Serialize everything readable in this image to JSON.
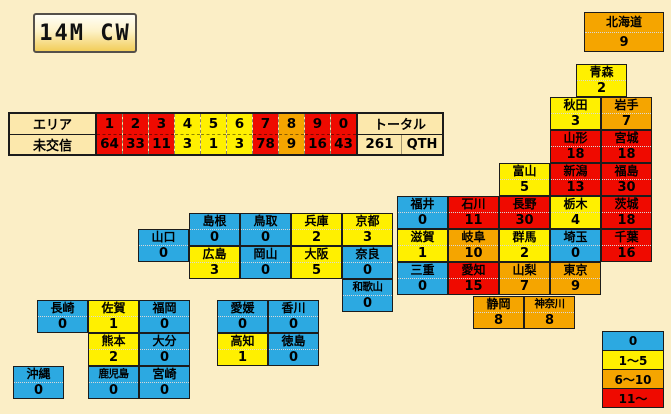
{
  "window": {
    "title": "14M CW"
  },
  "area_table": {
    "row1_label": "エリア",
    "row2_label": "未交信",
    "areas": [
      {
        "area": "1",
        "count": "64",
        "level": "red"
      },
      {
        "area": "2",
        "count": "33",
        "level": "red"
      },
      {
        "area": "3",
        "count": "11",
        "level": "red"
      },
      {
        "area": "4",
        "count": "3",
        "level": "yellow"
      },
      {
        "area": "5",
        "count": "1",
        "level": "yellow"
      },
      {
        "area": "6",
        "count": "3",
        "level": "yellow"
      },
      {
        "area": "7",
        "count": "78",
        "level": "red"
      },
      {
        "area": "8",
        "count": "9",
        "level": "orange"
      },
      {
        "area": "9",
        "count": "16",
        "level": "red"
      },
      {
        "area": "0",
        "count": "43",
        "level": "red"
      }
    ],
    "total_label": "トータル",
    "total_value": "261",
    "total_unit": "QTH"
  },
  "legend": {
    "items": [
      {
        "label": "0",
        "level": "blue"
      },
      {
        "label": "1～5",
        "level": "yellow"
      },
      {
        "label": "6～10",
        "level": "orange"
      },
      {
        "label": "11～",
        "level": "red"
      }
    ]
  },
  "map": {
    "prefectures": [
      {
        "name": "北海道",
        "count": "9",
        "level": "orange",
        "x": 584,
        "y": 12,
        "w": 80,
        "h": 40
      },
      {
        "name": "青森",
        "count": "2",
        "level": "yellow",
        "x": 576,
        "y": 64
      },
      {
        "name": "秋田",
        "count": "3",
        "level": "yellow",
        "x": 550,
        "y": 97
      },
      {
        "name": "岩手",
        "count": "7",
        "level": "orange",
        "x": 601,
        "y": 97
      },
      {
        "name": "山形",
        "count": "18",
        "level": "red",
        "x": 550,
        "y": 130
      },
      {
        "name": "宮城",
        "count": "18",
        "level": "red",
        "x": 601,
        "y": 130
      },
      {
        "name": "富山",
        "count": "5",
        "level": "yellow",
        "x": 499,
        "y": 163
      },
      {
        "name": "新潟",
        "count": "13",
        "level": "red",
        "x": 550,
        "y": 163
      },
      {
        "name": "福島",
        "count": "30",
        "level": "red",
        "x": 601,
        "y": 163
      },
      {
        "name": "福井",
        "count": "0",
        "level": "blue",
        "x": 397,
        "y": 196
      },
      {
        "name": "石川",
        "count": "11",
        "level": "red",
        "x": 448,
        "y": 196
      },
      {
        "name": "長野",
        "count": "30",
        "level": "red",
        "x": 499,
        "y": 196
      },
      {
        "name": "栃木",
        "count": "4",
        "level": "yellow",
        "x": 550,
        "y": 196
      },
      {
        "name": "茨城",
        "count": "18",
        "level": "red",
        "x": 601,
        "y": 196
      },
      {
        "name": "滋賀",
        "count": "1",
        "level": "yellow",
        "x": 397,
        "y": 229
      },
      {
        "name": "岐阜",
        "count": "10",
        "level": "orange",
        "x": 448,
        "y": 229
      },
      {
        "name": "群馬",
        "count": "2",
        "level": "yellow",
        "x": 499,
        "y": 229
      },
      {
        "name": "埼玉",
        "count": "0",
        "level": "blue",
        "x": 550,
        "y": 229
      },
      {
        "name": "千葉",
        "count": "16",
        "level": "red",
        "x": 601,
        "y": 229
      },
      {
        "name": "三重",
        "count": "0",
        "level": "blue",
        "x": 397,
        "y": 262
      },
      {
        "name": "愛知",
        "count": "15",
        "level": "red",
        "x": 448,
        "y": 262
      },
      {
        "name": "山梨",
        "count": "7",
        "level": "orange",
        "x": 499,
        "y": 262
      },
      {
        "name": "東京",
        "count": "9",
        "level": "orange",
        "x": 550,
        "y": 262
      },
      {
        "name": "静岡",
        "count": "8",
        "level": "orange",
        "x": 473,
        "y": 296
      },
      {
        "name": "神奈川",
        "count": "8",
        "level": "orange",
        "x": 524,
        "y": 296
      },
      {
        "name": "島根",
        "count": "0",
        "level": "blue",
        "x": 189,
        "y": 213
      },
      {
        "name": "鳥取",
        "count": "0",
        "level": "blue",
        "x": 240,
        "y": 213
      },
      {
        "name": "兵庫",
        "count": "2",
        "level": "yellow",
        "x": 291,
        "y": 213
      },
      {
        "name": "京都",
        "count": "3",
        "level": "yellow",
        "x": 342,
        "y": 213
      },
      {
        "name": "山口",
        "count": "0",
        "level": "blue",
        "x": 138,
        "y": 229
      },
      {
        "name": "広島",
        "count": "3",
        "level": "yellow",
        "x": 189,
        "y": 246
      },
      {
        "name": "岡山",
        "count": "0",
        "level": "blue",
        "x": 240,
        "y": 246
      },
      {
        "name": "大阪",
        "count": "5",
        "level": "yellow",
        "x": 291,
        "y": 246
      },
      {
        "name": "奈良",
        "count": "0",
        "level": "blue",
        "x": 342,
        "y": 246
      },
      {
        "name": "和歌山",
        "count": "0",
        "level": "blue",
        "x": 342,
        "y": 279
      },
      {
        "name": "愛媛",
        "count": "0",
        "level": "blue",
        "x": 217,
        "y": 300
      },
      {
        "name": "香川",
        "count": "0",
        "level": "blue",
        "x": 268,
        "y": 300
      },
      {
        "name": "高知",
        "count": "1",
        "level": "yellow",
        "x": 217,
        "y": 333
      },
      {
        "name": "徳島",
        "count": "0",
        "level": "blue",
        "x": 268,
        "y": 333
      },
      {
        "name": "長崎",
        "count": "0",
        "level": "blue",
        "x": 37,
        "y": 300
      },
      {
        "name": "佐賀",
        "count": "1",
        "level": "yellow",
        "x": 88,
        "y": 300
      },
      {
        "name": "福岡",
        "count": "0",
        "level": "blue",
        "x": 139,
        "y": 300
      },
      {
        "name": "熊本",
        "count": "2",
        "level": "yellow",
        "x": 88,
        "y": 333
      },
      {
        "name": "大分",
        "count": "0",
        "level": "blue",
        "x": 139,
        "y": 333
      },
      {
        "name": "鹿児島",
        "count": "0",
        "level": "blue",
        "x": 88,
        "y": 366
      },
      {
        "name": "宮崎",
        "count": "0",
        "level": "blue",
        "x": 139,
        "y": 366
      },
      {
        "name": "沖縄",
        "count": "0",
        "level": "blue",
        "x": 13,
        "y": 366
      }
    ]
  },
  "colors": {
    "blue": "#2CA9E1",
    "yellow": "#FFF000",
    "orange": "#F5A500",
    "red": "#EF0A00",
    "background": "#FBEEC6",
    "panel": "#FCE8AC"
  }
}
